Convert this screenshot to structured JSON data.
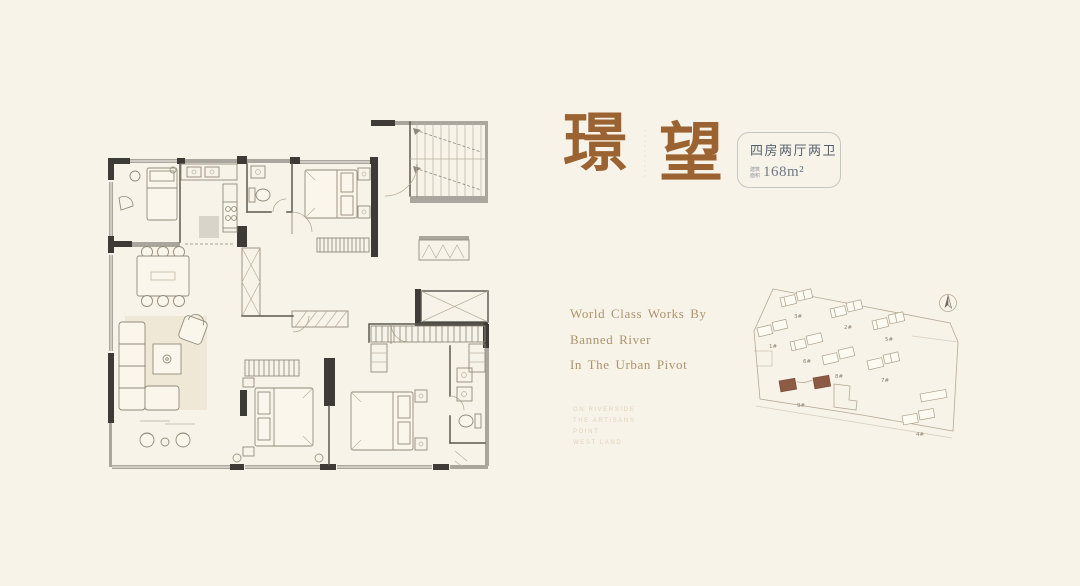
{
  "page": {
    "background": "#f8f3e9"
  },
  "title": {
    "char1": "璟",
    "char2": "望",
    "seal_marks": "··········",
    "color": "#9b6331"
  },
  "spec_box": {
    "layout_label": "四房两厅两卫",
    "area_prefix": [
      "建筑",
      "面积"
    ],
    "area_value": "168m²"
  },
  "tagline": {
    "lines": [
      "World Class Works By",
      "Banned River",
      "In The Urban Pivot"
    ]
  },
  "fine_print": {
    "lines": [
      "ON RIVERSIDE",
      "THE ARTISANS",
      "POINT",
      "WEST LAND"
    ]
  },
  "site_plan": {
    "building_labels": [
      "3#",
      "2#",
      "5#",
      "1#",
      "6#",
      "8#",
      "7#",
      "9#",
      "4#"
    ],
    "highlighted_building": "9#",
    "highlight_color": "#8d5a43",
    "compass": "north-arrow"
  }
}
